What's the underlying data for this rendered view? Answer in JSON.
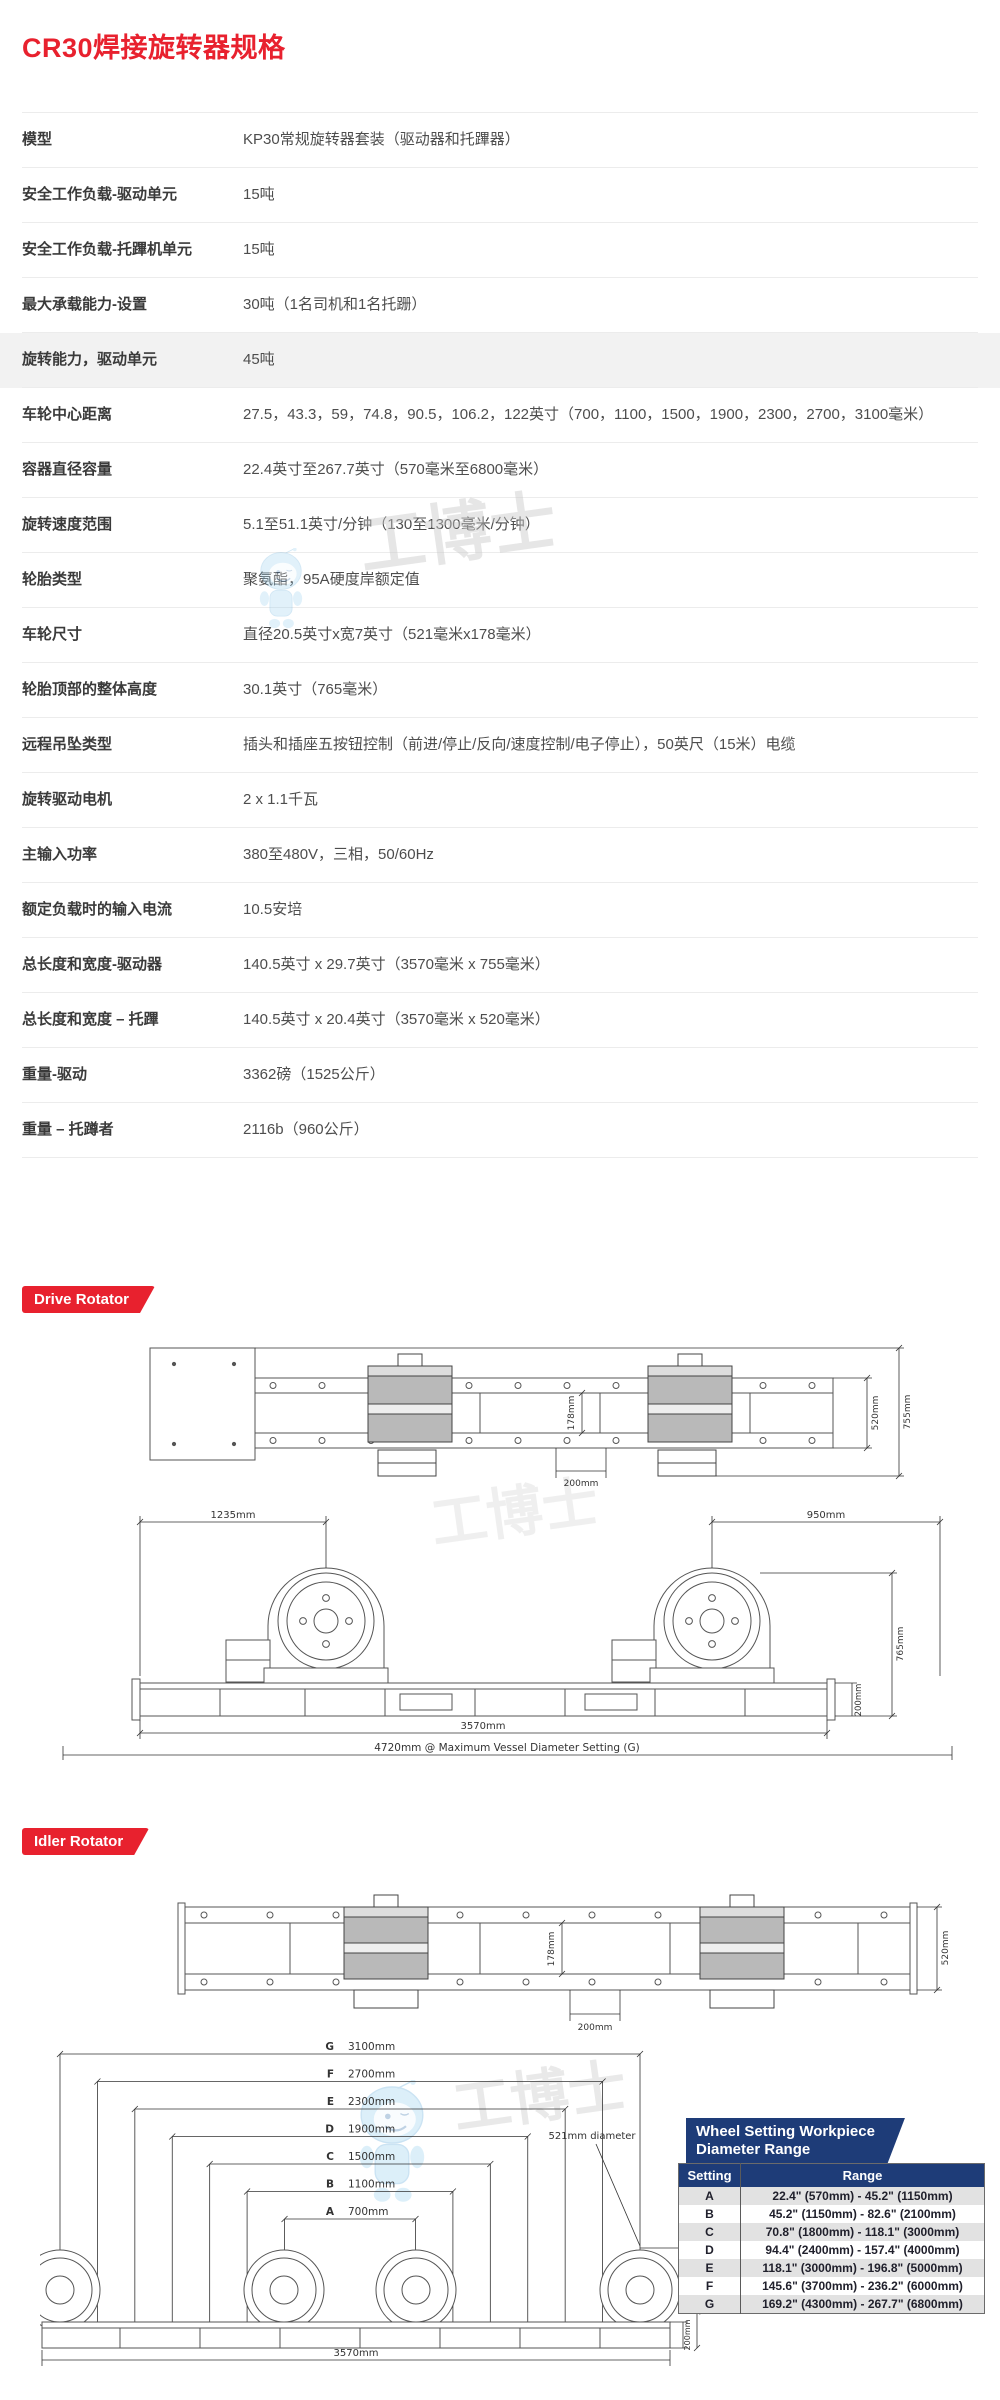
{
  "page": {
    "title": "CR30焊接旋转器规格"
  },
  "colors": {
    "accent_red": "#e8212e",
    "navy": "#1e3c78"
  },
  "spec_table": {
    "rows": [
      {
        "label": "模型",
        "value": "KP30常规旋转器套装（驱动器和托蹕器）"
      },
      {
        "label": "安全工作负载-驱动单元",
        "value": "15吨"
      },
      {
        "label": "安全工作负载-托蹕机单元",
        "value": "15吨"
      },
      {
        "label": "最大承载能力-设置",
        "value": "30吨（1名司机和1名托跚）"
      },
      {
        "label": "旋转能力，驱动单元",
        "value": "45吨",
        "shaded": true
      },
      {
        "label": "车轮中心距离",
        "value": "27.5，43.3，59，74.8，90.5，106.2，122英寸（700，1100，1500，1900，2300，2700，3100毫米）"
      },
      {
        "label": "容器直径容量",
        "value": "22.4英寸至267.7英寸（570毫米至6800毫米）"
      },
      {
        "label": "旋转速度范围",
        "value": "5.1至51.1英寸/分钟（130至1300毫米/分钟）"
      },
      {
        "label": "轮胎类型",
        "value": "聚氨酯，95A硬度岸额定值"
      },
      {
        "label": "车轮尺寸",
        "value": "直径20.5英寸x宽7英寸（521毫米x178毫米）"
      },
      {
        "label": "轮胎顶部的整体高度",
        "value": "30.1英寸（765毫米）"
      },
      {
        "label": "远程吊坠类型",
        "value": "插头和插座五按钮控制（前进/停止/反向/速度控制/电子停止），50英尺（15米）电缆"
      },
      {
        "label": "旋转驱动电机",
        "value": "2 x 1.1千瓦"
      },
      {
        "label": "主输入功率",
        "value": "380至480V，三相，50/60Hz"
      },
      {
        "label": "额定负载时的输入电流",
        "value": "10.5安培"
      },
      {
        "label": "总长度和宽度-驱动器",
        "value": "140.5英寸 x 29.7英寸（3570毫米 x 755毫米）"
      },
      {
        "label": "总长度和宽度 – 托蹕",
        "value": "140.5英寸 x 20.4英寸（3570毫米 x 520毫米）"
      },
      {
        "label": "重量-驱动",
        "value": "3362磅（1525公斤）"
      },
      {
        "label": "重量 – 托蹲者",
        "value": "2116b（960公斤）"
      }
    ]
  },
  "drive_section": {
    "badge": "Drive Rotator",
    "top_view": {
      "dims": {
        "wheel_face": "178mm",
        "wheel_offset": "200mm",
        "frame_width": "520mm",
        "overall_width": "755mm"
      }
    },
    "front_view": {
      "dims": {
        "left_wheel_span": "1235mm",
        "right_wheel_span": "950mm",
        "overall_height": "765mm",
        "base_height": "200mm",
        "frame_length": "3570mm",
        "max_setting_span": "4720mm @ Maximum Vessel Diameter Setting (G)"
      }
    }
  },
  "idler_section": {
    "badge": "Idler Rotator",
    "top_view": {
      "dims": {
        "wheel_face": "178mm",
        "wheel_offset": "200mm",
        "frame_width": "520mm"
      }
    },
    "front_view": {
      "settings": [
        {
          "letter": "G",
          "value": "3100mm"
        },
        {
          "letter": "F",
          "value": "2700mm"
        },
        {
          "letter": "E",
          "value": "2300mm"
        },
        {
          "letter": "D",
          "value": "1900mm"
        },
        {
          "letter": "C",
          "value": "1500mm"
        },
        {
          "letter": "B",
          "value": "1100mm"
        },
        {
          "letter": "A",
          "value": "700mm"
        }
      ],
      "wheel_diameter_label": "521mm diameter",
      "dims": {
        "overall_height": "765mm",
        "base_height": "200mm",
        "frame_length": "3570mm"
      }
    }
  },
  "wheel_table": {
    "title_line1": "Wheel Setting Workpiece",
    "title_line2": "Diameter Range",
    "headers": {
      "setting": "Setting",
      "range": "Range"
    },
    "rows": [
      {
        "setting": "A",
        "range": "22.4\" (570mm) - 45.2\" (1150mm)"
      },
      {
        "setting": "B",
        "range": "45.2\" (1150mm) - 82.6\" (2100mm)"
      },
      {
        "setting": "C",
        "range": "70.8\" (1800mm) - 118.1\" (3000mm)"
      },
      {
        "setting": "D",
        "range": "94.4\" (2400mm) - 157.4\" (4000mm)"
      },
      {
        "setting": "E",
        "range": "118.1\" (3000mm) - 196.8\" (5000mm)"
      },
      {
        "setting": "F",
        "range": "145.6\" (3700mm) - 236.2\" (6000mm)"
      },
      {
        "setting": "G",
        "range": "169.2\" (4300mm) - 267.7\" (6800mm)"
      }
    ]
  },
  "watermark": {
    "brand": "工博士"
  }
}
